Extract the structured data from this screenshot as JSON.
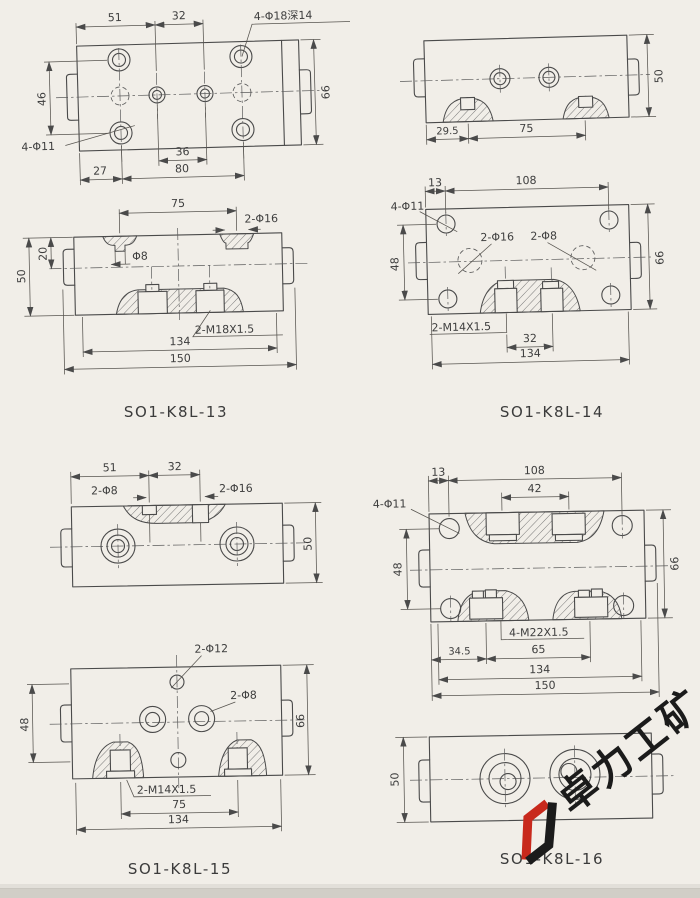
{
  "sheet": {
    "bg_color": "#f1eee8",
    "line_color": "#4a4a4a"
  },
  "d13": {
    "label": "SO1-K8L-13",
    "top": {
      "dim_51": "51",
      "dim_32": "32",
      "note_holes": "4-Φ18深14",
      "dim_46": "46",
      "note_phi11": "4-Φ11",
      "dim_66": "66",
      "dim_36": "36",
      "dim_27": "27",
      "dim_80": "80"
    },
    "front": {
      "dim_75": "75",
      "note_2phi16": "2-Φ16",
      "dim_20": "20",
      "dim_50": "50",
      "note_phi8": "Φ8",
      "note_thread": "2-M18X1.5",
      "dim_134": "134",
      "dim_150": "150"
    }
  },
  "d14": {
    "label": "SO1-K8L-14",
    "top": {
      "dim_29_5": "29.5",
      "dim_75": "75",
      "dim_50": "50"
    },
    "main": {
      "dim_13": "13",
      "dim_108": "108",
      "note_phi11": "4-Φ11",
      "note_2phi16": "2-Φ16",
      "note_2phi8": "2-Φ8",
      "dim_48": "48",
      "dim_66": "66",
      "note_thread": "2-M14X1.5",
      "dim_32": "32",
      "dim_134": "134"
    }
  },
  "d15": {
    "label": "SO1-K8L-15",
    "top": {
      "dim_51": "51",
      "dim_32": "32",
      "note_2phi8": "2-Φ8",
      "note_2phi16": "2-Φ16",
      "dim_50": "50"
    },
    "main": {
      "dim_67": "67",
      "note_2phi12": "2-Φ12",
      "note_2phi8": "2-Φ8",
      "dim_48": "48",
      "dim_66": "66",
      "note_thread": "2-M14X1.5",
      "dim_75": "75",
      "dim_134": "134"
    }
  },
  "d16": {
    "label": "SO1-K8L-16",
    "main": {
      "dim_13": "13",
      "dim_108": "108",
      "dim_42": "42",
      "note_phi11": "4-Φ11",
      "dim_48": "48",
      "dim_66": "66",
      "note_thread": "4-M22X1.5",
      "dim_34_5": "34.5",
      "dim_65": "65",
      "dim_134": "134",
      "dim_150": "150"
    },
    "bottom": {
      "dim_50": "50"
    }
  },
  "watermark": {
    "text": "卓力工矿",
    "red": "#c8291c",
    "black": "#1b1b1b"
  }
}
